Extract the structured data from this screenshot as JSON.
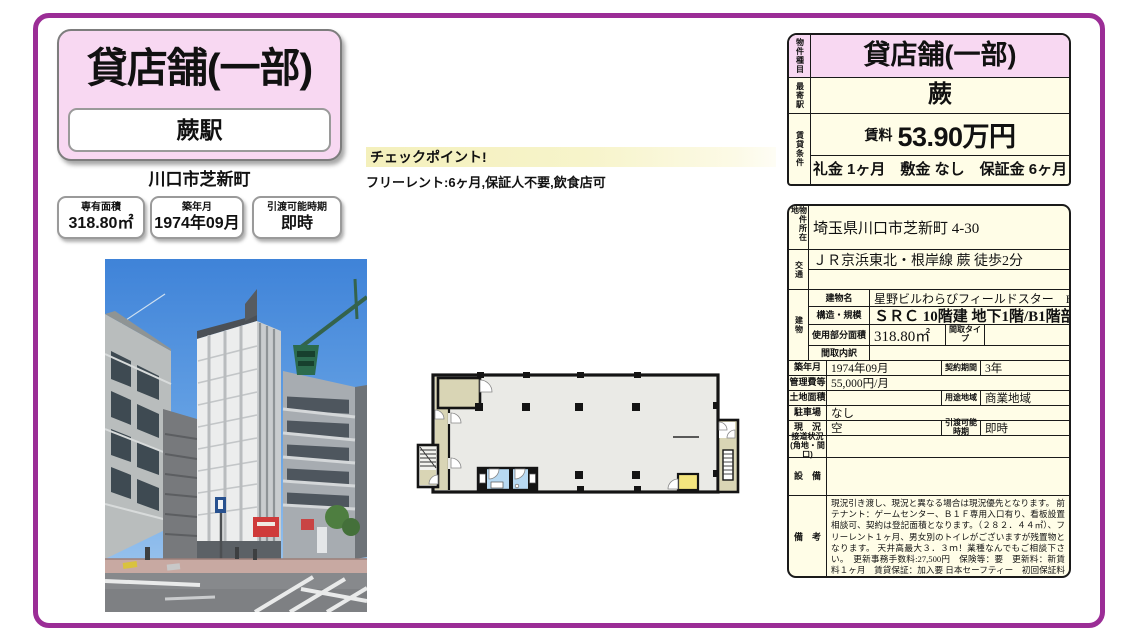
{
  "header": {
    "title": "貸店舗(一部)",
    "station": "蕨駅",
    "city": "川口市芝新町"
  },
  "stat_boxes": [
    {
      "label": "専有面積",
      "value": "318.80㎡"
    },
    {
      "label": "築年月",
      "value": "1974年09月"
    },
    {
      "label": "引渡可能時期",
      "value": "即時"
    }
  ],
  "checkpoint": {
    "title": "チェックポイント!",
    "body": "フリーレント:6ヶ月,保証人不要,飲食店可"
  },
  "summary_table": {
    "property_type_label": "物件種目",
    "property_type": "貸店舗(一部)",
    "nearest_station_label": "最寄駅",
    "nearest_station": "蕨",
    "lease_terms_label": "賃貸条件",
    "rent_label": "賃料",
    "rent": "53.90万円",
    "fees": "礼金 1ヶ月　敷金 なし　保証金 6ヶ月"
  },
  "detail_table": {
    "address_label": "物件所在地",
    "address": "埼玉県川口市芝新町 4-30",
    "access_label": "交通",
    "access": "ＪＲ京浜東北・根岸線 蕨 徒歩2分",
    "access_line2": "",
    "building_label": "建物",
    "building_name_label": "建物名",
    "building_name": "星野ビルわらびフィールドスター　B1F",
    "structure_label": "構造・規模",
    "structure": "ＳＲＣ 10階建 地下1階/B1階部分",
    "floor_area_label": "使用部分面積",
    "floor_area": "318.80㎡",
    "layout_type_label": "間取タイプ",
    "layout_type": "",
    "layout_detail_label": "間取内訳",
    "layout_detail": "",
    "built_label": "築年月",
    "built": "1974年09月",
    "contract_label": "契約期間",
    "contract": "3年",
    "mgmt_fee_label": "管理費等",
    "mgmt_fee": "55,000円/月",
    "land_label": "土地面積",
    "land": "",
    "zoning_label": "用途地域",
    "zoning": "商業地域",
    "parking_label": "駐車場",
    "parking": "なし",
    "status_label": "現　況",
    "status": "空",
    "handover_label": "引渡可能時期",
    "handover": "即時",
    "road_label": "接道状況 (角地・間口)",
    "road": "",
    "equipment_label": "設　備",
    "equipment": "",
    "remarks_label": "備　考",
    "remarks": "現況引き渡し、現況と異なる場合は現況優先となります。 前テナント：ゲームセンター、Ｂ１Ｆ専用入口有り、看板設置相談可、契約は登記面積となります。（２８２．４４㎡）、フリーレント１ヶ月、男女別のトイレがございますが残置物となります。 天井高最大３．３ｍ！業種なんでもご相談下さい。　更新事務手数料:27,500円　保険等：要　更新料：新賃料１ヶ月　賃貸保証：加入要 日本セーフティー　初回保証料賃料総額１００％～・月額更新継続保証料：賃料・共益費の０．８％　利用駅１：ＪＲ京浜東北・根岸線 西川口 徒歩26分"
  },
  "colors": {
    "frame_purple": "#9b2d96",
    "card_pink": "#f8d8f2",
    "cell_cream": "#fffde7",
    "checkpoint_yellow": "#f4f0bc",
    "plan_beige": "#d9d5b5",
    "plan_blue": "#b7d9f2",
    "plan_yellow": "#f4e57e"
  }
}
